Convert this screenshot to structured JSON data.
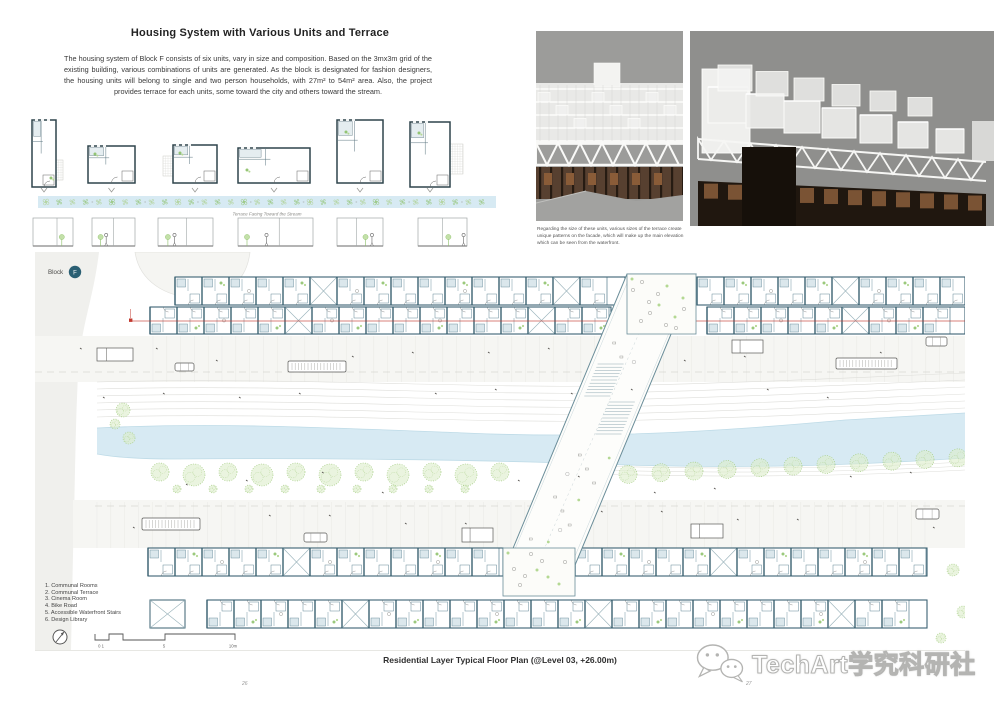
{
  "header": {
    "title": "Housing System with Various Units and Terrace",
    "intro": "The housing system of Block F consists of six units, vary in size and composition. Based on the 3mx3m grid of the existing building,  various combinations of units are generated. As the block is designated for fashion designers, the housing units will belong to single and two person households, with 27m² to 54m² area. Also, the project provides terrace for each units, some toward the city and others toward the stream."
  },
  "units_figure": {
    "terrace_label": "Terrace Facing Toward the Stream"
  },
  "photos": {
    "caption": "Regarding the size of these units, various sizes of the terrace create unique patterns on the facade, which will make up the main elevation which can be seen from the waterfront."
  },
  "plan": {
    "block_label": "Block",
    "block_letter": "F",
    "legend": [
      "1. Communal Rooms",
      "2. Communal Terrace",
      "3. Cinema Room",
      "4. Bike Road",
      "5. Accessible Waterfront Stairs",
      "6. Design Library"
    ],
    "scale_labels": [
      "0 1",
      "5",
      "10m"
    ],
    "caption": "Residential Layer Typical Floor Plan (@Level 03, +26.00m)"
  },
  "footer": {
    "page_left": "26",
    "page_right": "27"
  },
  "watermark": {
    "text": "TechArt学究科研社"
  },
  "colors": {
    "wall": "#527b8c",
    "wall_dark": "#3b6272",
    "bath_fill": "#dbe7ec",
    "green": "#8abf65",
    "green_light": "#b4d893",
    "tree_fill": "#dcecc9",
    "stream": "#d7eaf3",
    "stream_edge": "#bedbe7",
    "red_line": "#c2392f",
    "badge": "#2a5f73",
    "contour": "#dededa"
  }
}
